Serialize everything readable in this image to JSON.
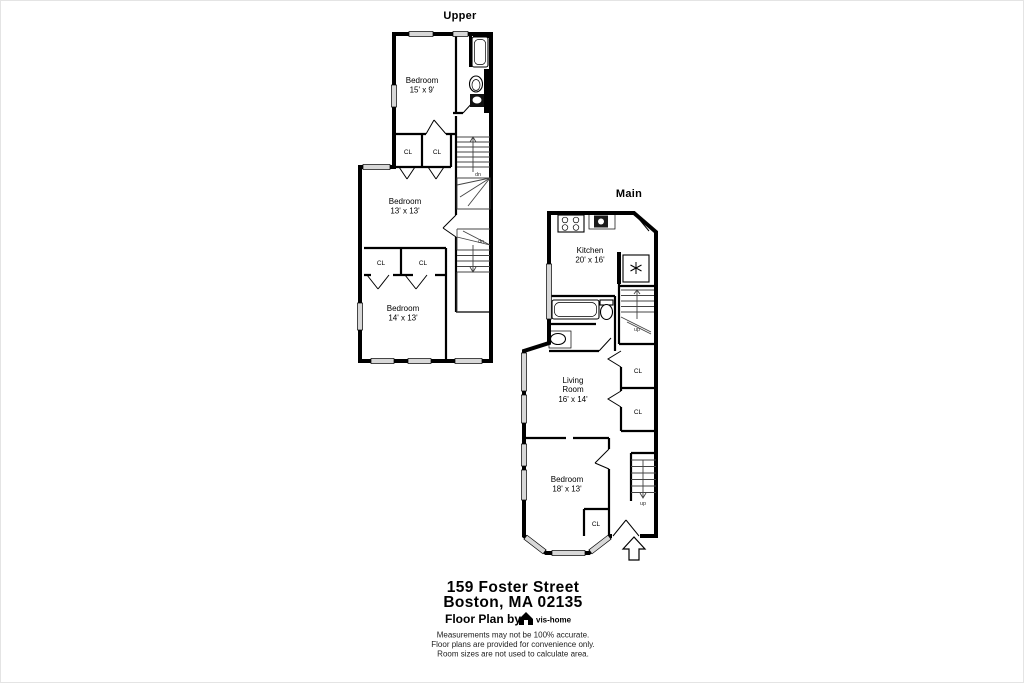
{
  "meta": {
    "background_color": "#ffffff",
    "ink_color": "#000000",
    "window_fill_color": "#d8d8d8"
  },
  "upper": {
    "title": "Upper",
    "rooms": {
      "bedroom1": {
        "name": "Bedroom",
        "dims": "15' x 9'"
      },
      "bedroom2": {
        "name": "Bedroom",
        "dims": "13' x 13'"
      },
      "bedroom3": {
        "name": "Bedroom",
        "dims": "14' x 13'"
      }
    },
    "closets": {
      "cl1": "CL",
      "cl2": "CL",
      "cl3": "CL",
      "cl4": "CL"
    },
    "stairs": {
      "dn1": "dn",
      "dn2": "dn"
    },
    "fixtures": [
      "bathtub",
      "toilet",
      "sink"
    ]
  },
  "main": {
    "title": "Main",
    "rooms": {
      "kitchen": {
        "name": "Kitchen",
        "dims": "20' x 16'"
      },
      "living": {
        "name_line1": "Living",
        "name_line2": "Room",
        "dims": "16' x 14'"
      },
      "bedroom": {
        "name": "Bedroom",
        "dims": "18' x 13'"
      }
    },
    "closets": {
      "cl1": "CL",
      "cl2": "CL",
      "cl3": "CL"
    },
    "stairs": {
      "up1": "up",
      "up2": "up"
    },
    "fixtures": [
      "stove",
      "kitchen-sink",
      "refrigerator",
      "bathtub",
      "toilet",
      "sink"
    ]
  },
  "footer": {
    "address_line1": "159 Foster Street",
    "address_line2": "Boston, MA 02135",
    "credit_prefix": "Floor Plan by",
    "brand": "vis-home",
    "disclaimer1": "Measurements may not be 100% accurate.",
    "disclaimer2": "Floor plans are provided for convenience only.",
    "disclaimer3": "Room sizes are not used to calculate area."
  }
}
